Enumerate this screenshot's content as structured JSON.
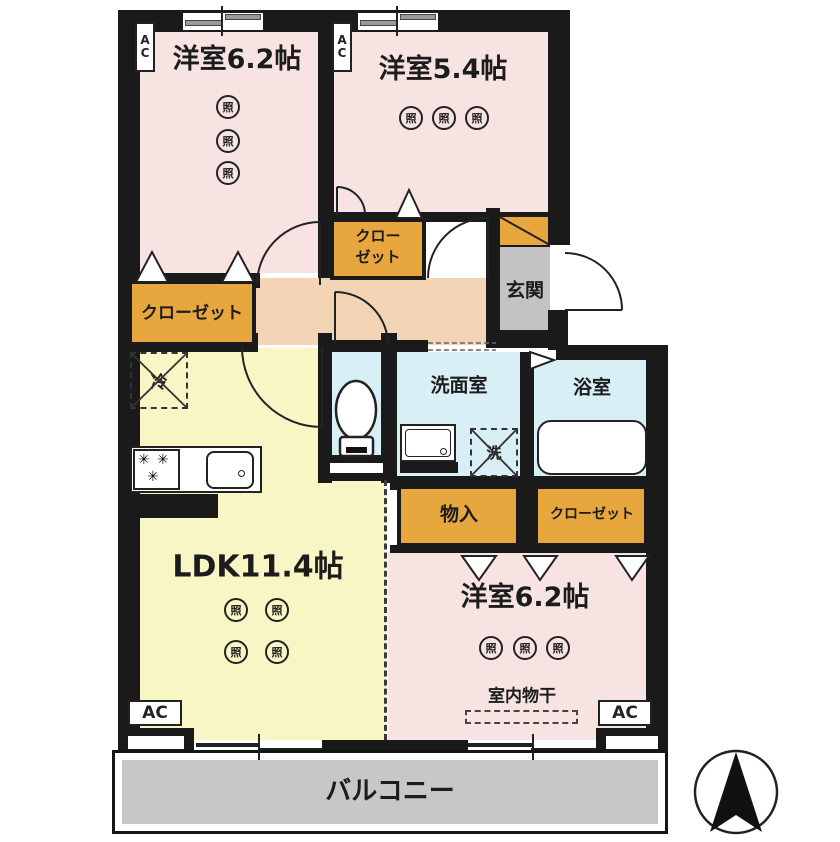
{
  "labels": {
    "room_top_left": "洋室6.2帖",
    "room_top_right": "洋室5.4帖",
    "room_bottom_right": "洋室6.2帖",
    "ldk": "LDK11.4帖",
    "washroom": "洗面室",
    "bathroom": "浴室",
    "entrance": "玄関",
    "closet_left": "クローゼット",
    "closet_top_line1": "クロー",
    "closet_top_line2": "ゼット",
    "closet_right": "クローゼット",
    "storage": "物入",
    "indoor_drying": "室内物干",
    "balcony": "バルコニー"
  },
  "symbols": {
    "light": "照",
    "fridge": "冷",
    "washer": "洗",
    "burner": "✳",
    "ac": "AC",
    "ac_a": "A",
    "ac_c": "C"
  },
  "colors": {
    "wall": "#1a1a1a",
    "room_pink": "#f8e3e3",
    "ldk_yellow": "#f9f6c5",
    "closet_orange": "#e8a73e",
    "hall_tan": "#f3d5b5",
    "entrance_gray": "#c3c3c3",
    "wet_area_blue": "#d8eff5",
    "balcony_gray": "#c7c7c7"
  }
}
